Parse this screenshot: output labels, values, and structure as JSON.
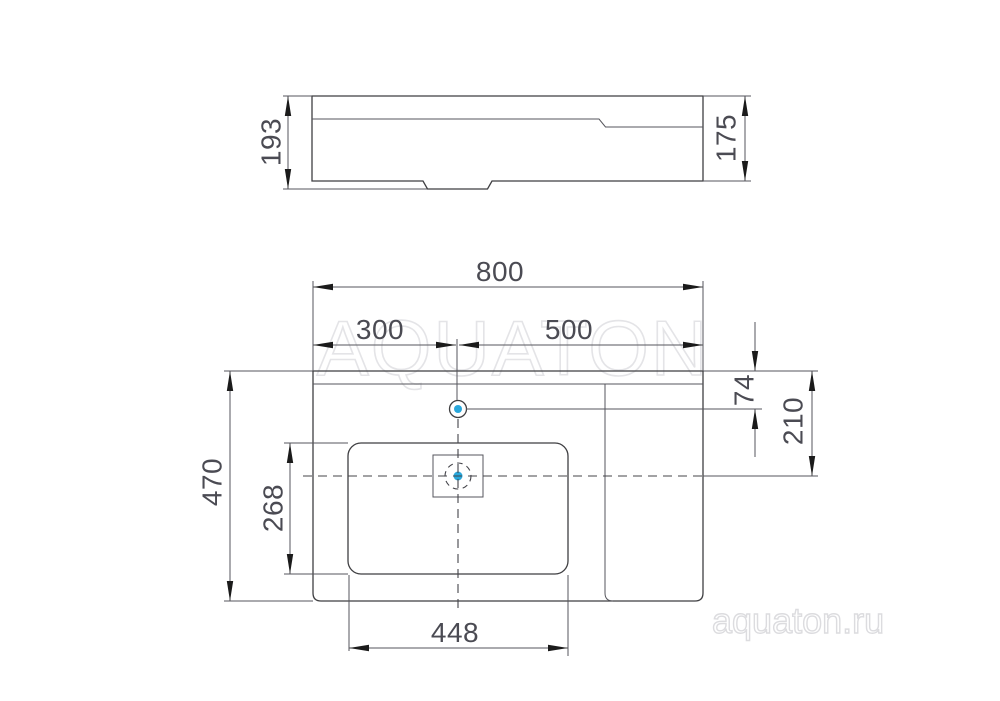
{
  "watermarks": {
    "center": "AQUATON",
    "corner": "aquaton.ru"
  },
  "colors": {
    "accent_blue": "#29a7db",
    "line_dark": "#3f3f42",
    "line_gray": "#56565c",
    "dim_text": "#4b4b53",
    "watermark_stroke": "#e4e4e7"
  },
  "side_view": {
    "height_overall": "193",
    "height_body": "175"
  },
  "plan_view": {
    "width_overall": "800",
    "faucet_offset_left": "300",
    "faucet_offset_right": "500",
    "faucet_from_back": "74",
    "drain_from_back": "210",
    "depth_overall": "470",
    "bowl_depth": "268",
    "bowl_width": "448"
  }
}
